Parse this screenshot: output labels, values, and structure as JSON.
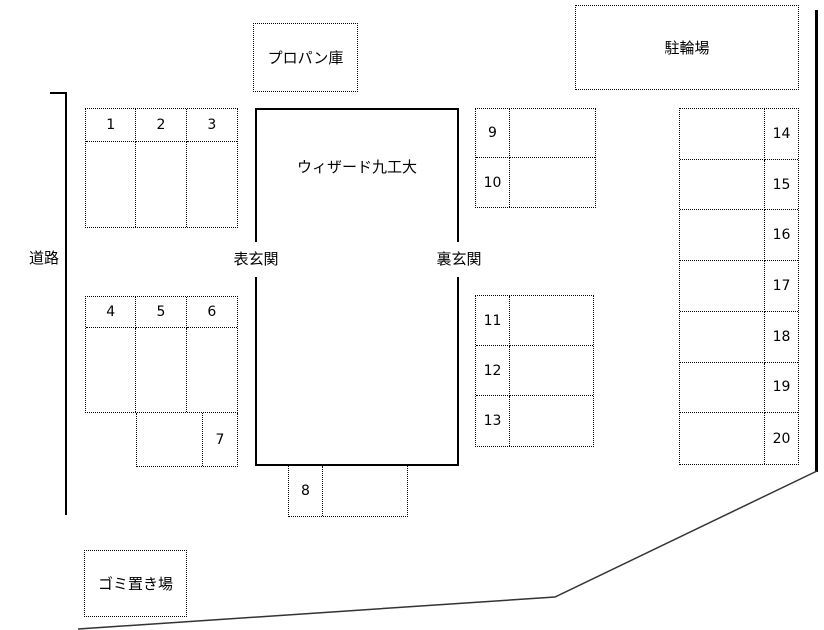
{
  "labels": {
    "road": "道路",
    "propane_storage": "プロパン庫",
    "bicycle_parking": "駐輪場",
    "building_name": "ウィザード九工大",
    "front_entrance": "表玄関",
    "back_entrance": "裏玄関",
    "garbage_area": "ゴミ置き場"
  },
  "parking_spots": {
    "group_1_3": [
      "1",
      "2",
      "3"
    ],
    "group_4_6": [
      "4",
      "5",
      "6"
    ],
    "spot_7": "7",
    "spot_8": "8",
    "group_9_10": [
      "9",
      "10"
    ],
    "group_11_13": [
      "11",
      "12",
      "13"
    ],
    "group_14_20": [
      "14",
      "15",
      "16",
      "17",
      "18",
      "19",
      "20"
    ]
  },
  "colors": {
    "background": "#ffffff",
    "line": "#000000",
    "boundary": "#333333"
  }
}
